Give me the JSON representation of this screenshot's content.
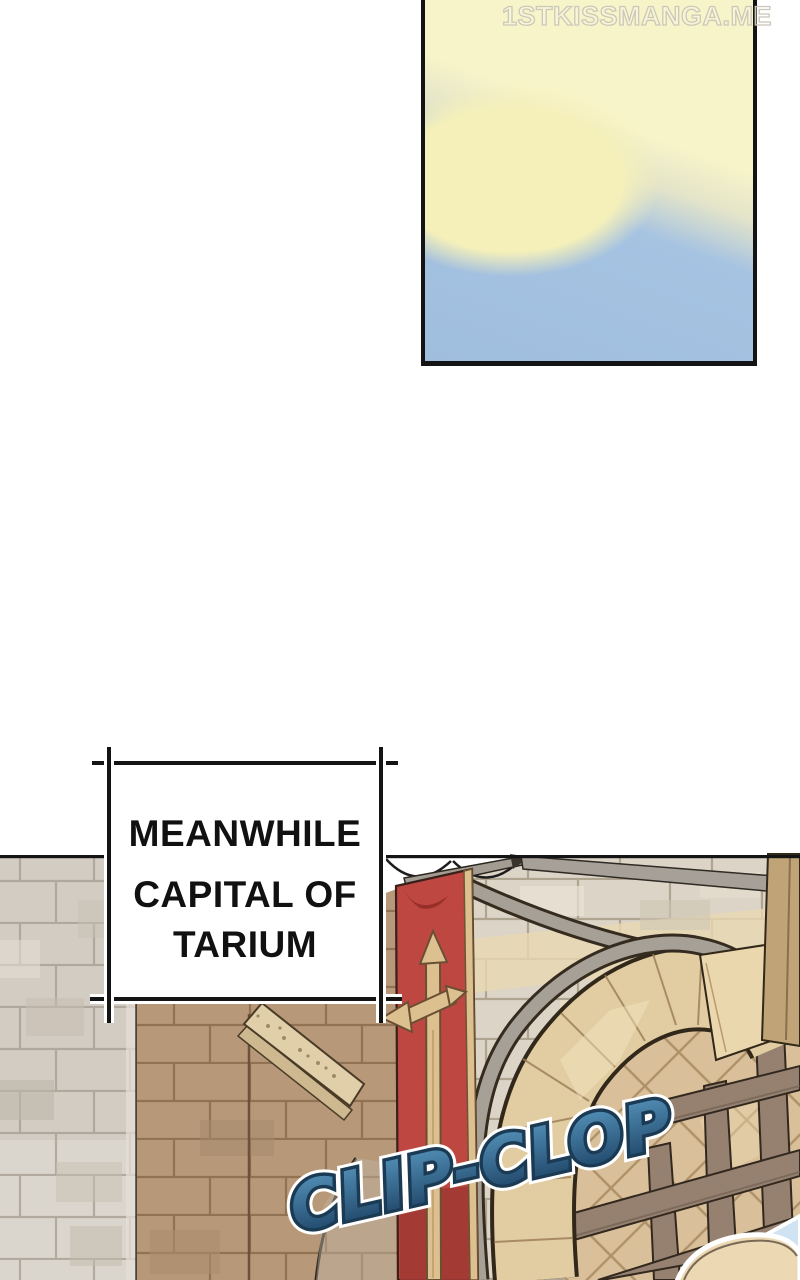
{
  "watermark": {
    "text": "1STKISSMANGA.ME",
    "color": "#cbc8ba"
  },
  "caption_box": {
    "line1": "MEANWHILE",
    "line2": "CAPITAL OF",
    "line3": "TARIUM",
    "border_color": "#141414",
    "background": "#ffffff",
    "text_color": "#111111"
  },
  "sfx": {
    "text": "CLIP-CLOP",
    "fill_top": "#4d87ae",
    "fill_bottom": "#265073",
    "outline_color": "#1b3a54",
    "halo_color": "#ffffff"
  },
  "sky_panel": {
    "border_color": "#141414",
    "sky_top_color": "#f8f4c9",
    "sky_cloud_color": "#f5f0ba",
    "sky_bottom_color": "#a6c3e2"
  },
  "artwork": {
    "scene": "castle-gate-of-tarium",
    "banner": {
      "emblem": "sword-banner",
      "red": "#bf4741",
      "dark_red": "#a03a33",
      "gold": "#dcc08f"
    },
    "walls": {
      "gray_stone": "#d3ccc3",
      "brown_stone": "#b79878",
      "light_stone": "#dcd4c6",
      "arch_tan": "#e2cca1",
      "molding_gray": "#a7a096",
      "lattice_brown": "#968171",
      "diamond_tan": "#d9c09a"
    }
  }
}
